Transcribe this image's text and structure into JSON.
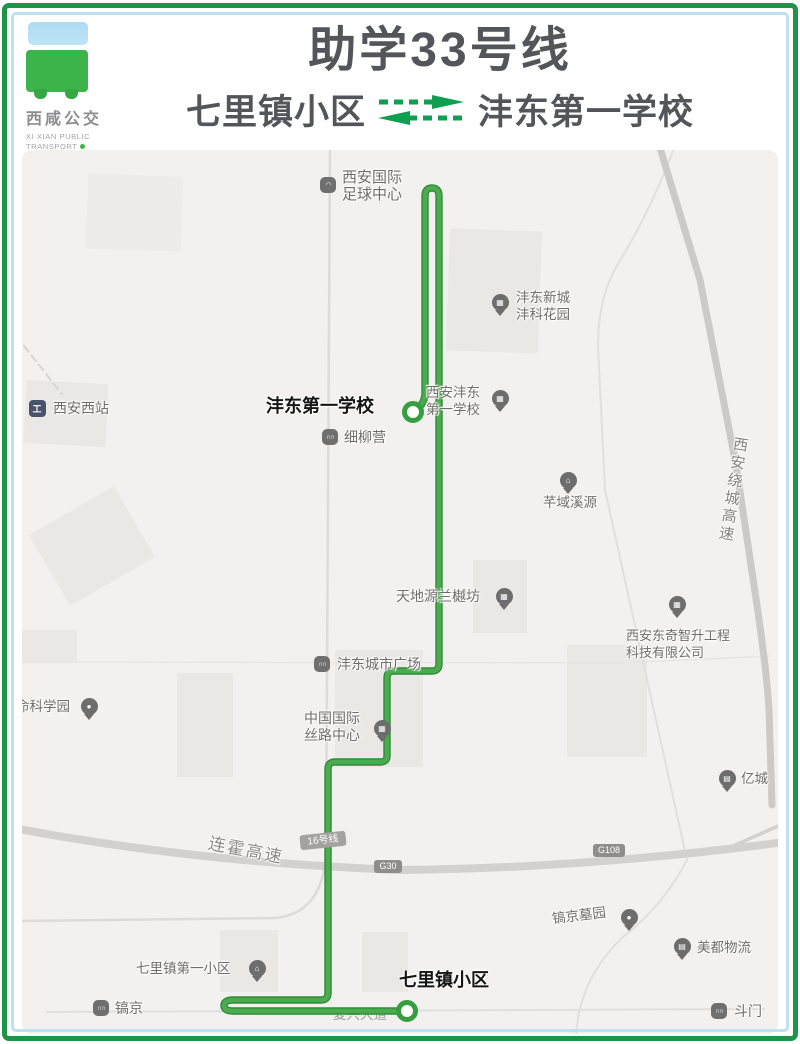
{
  "colors": {
    "accent_green": "#1d9447",
    "route_green": "#43a047",
    "title_gray": "#54555a",
    "map_background": "#f2f1ef",
    "frame_blue": "#bfe0f2"
  },
  "header": {
    "logo": {
      "name_cn": "西咸公交",
      "name_en_line1": "XI XIAN PUBLIC",
      "name_en_line2": "TRANSPORT"
    },
    "line_name": "助学33号线",
    "origin": "七里镇小区",
    "destination": "沣东第一学校"
  },
  "map": {
    "stations": {
      "fengdong_school": {
        "label": "沣东第一学校"
      },
      "qilizhen": {
        "label": "七里镇小区"
      }
    },
    "pois": {
      "football_center": {
        "lines": [
          "西安国际",
          "足球中心"
        ]
      },
      "fengke_garden": {
        "lines": [
          "沣东新城",
          "沣科花园"
        ]
      },
      "xian_west_station": {
        "lines": [
          "西安西站"
        ]
      },
      "fengdong_school_poi": {
        "lines": [
          "西安沣东",
          "第一学校"
        ]
      },
      "xiliuying": {
        "lines": [
          "细柳营"
        ]
      },
      "qianyu_xiyuan": {
        "lines": [
          "芊域溪源"
        ]
      },
      "tiandiyuan": {
        "lines": [
          "天地源兰樾坊"
        ]
      },
      "fengdong_plaza": {
        "lines": [
          "沣东城市广场"
        ]
      },
      "silk_road_center": {
        "lines": [
          "中国国际",
          "丝路中心"
        ]
      },
      "science_park": {
        "lines": [
          "命科学园"
        ]
      },
      "dongqi_company": {
        "lines": [
          "西安东奇智升工程",
          "科技有限公司"
        ]
      },
      "yicheng": {
        "lines": [
          "亿城"
        ]
      },
      "haojing_cemetery": {
        "lines": [
          "镐京墓园"
        ]
      },
      "meidu_logistics": {
        "lines": [
          "美都物流"
        ]
      },
      "doumen": {
        "lines": [
          "斗门"
        ]
      },
      "haojing": {
        "lines": [
          "镐京"
        ]
      },
      "qilizhen_first_community": {
        "lines": [
          "七里镇第一小区"
        ]
      }
    },
    "road_labels": {
      "lianhuo": "连霍高速",
      "raocheng": "西安绕城高速",
      "fuxing": "复兴大道"
    },
    "badges": {
      "line16": "16号线",
      "g30": "G30",
      "g108": "G108"
    }
  }
}
